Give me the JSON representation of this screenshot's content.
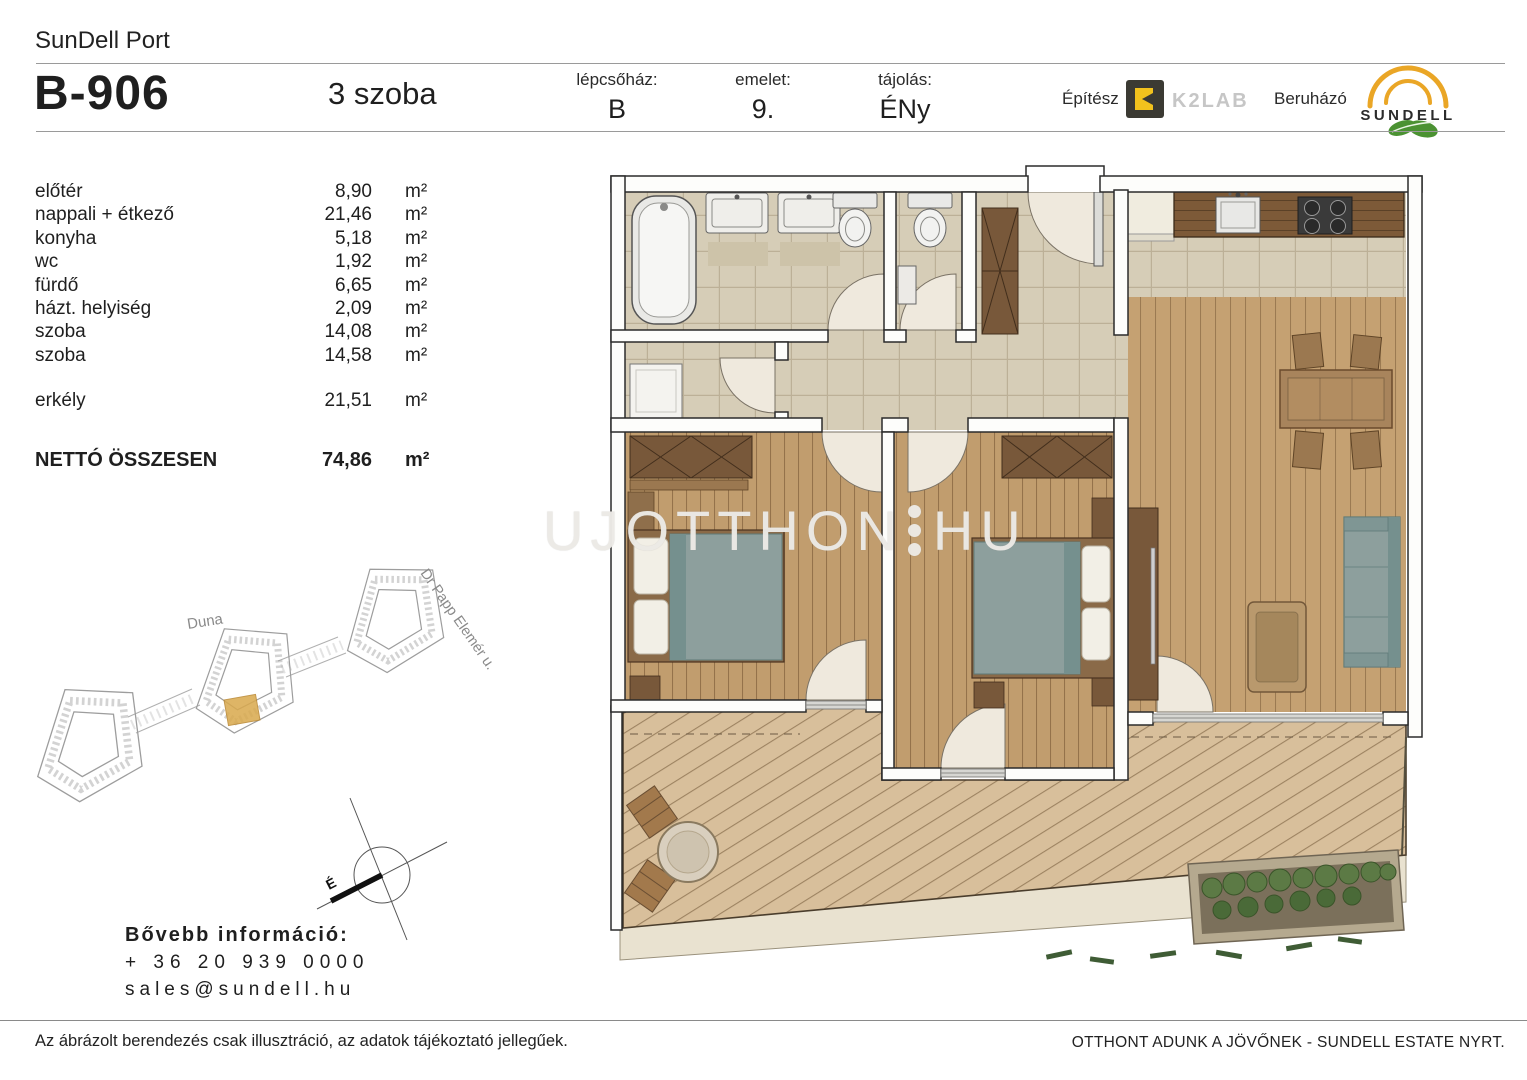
{
  "header": {
    "project": "SunDell Port",
    "unit_id": "B-906",
    "unit_type": "3 szoba",
    "fields": [
      {
        "label": "lépcsőház:",
        "value": "B"
      },
      {
        "label": "emelet:",
        "value": "9."
      },
      {
        "label": "tájolás:",
        "value": "ÉNy"
      }
    ],
    "architect_label": "Építész",
    "architect_name": "K2LAB",
    "developer_label": "Beruházó",
    "developer_name": "SUNDELL"
  },
  "rooms": {
    "items": [
      {
        "name": "előtér",
        "area": "8,90",
        "unit": "m²"
      },
      {
        "name": "nappali + étkező",
        "area": "21,46",
        "unit": "m²"
      },
      {
        "name": "konyha",
        "area": "5,18",
        "unit": "m²"
      },
      {
        "name": "wc",
        "area": "1,92",
        "unit": "m²"
      },
      {
        "name": "fürdő",
        "area": "6,65",
        "unit": "m²"
      },
      {
        "name": "házt. helyiség",
        "area": "2,09",
        "unit": "m²"
      },
      {
        "name": "szoba",
        "area": "14,08",
        "unit": "m²"
      },
      {
        "name": "szoba",
        "area": "14,58",
        "unit": "m²"
      }
    ],
    "balcony": {
      "name": "erkély",
      "area": "21,51",
      "unit": "m²"
    },
    "total": {
      "name": "NETTÓ ÖSSZESEN",
      "area": "74,86",
      "unit": "m²"
    }
  },
  "site_map": {
    "street1": "Duna",
    "street2": "Dr Papp Elemér u."
  },
  "compass": {
    "north": "É"
  },
  "watermark": {
    "left": "UJOTTHON",
    "right": "HU"
  },
  "contact": {
    "title": "Bővebb információ:",
    "phone": "+ 36 20 939 0000",
    "email": "sales@sundell.hu"
  },
  "footer": {
    "left": "Az ábrázolt berendezés csak illusztráció, az adatok tájékoztató jellegűek.",
    "right": "OTTHONT ADUNK A JÖVŐNEK - SUNDELL ESTATE NYRT."
  },
  "colors": {
    "brand_yellow": "#eaa626",
    "k2lab_yellow": "#f2c21d",
    "leaf_green": "#4b9232",
    "highlight_orange": "#d9a94c",
    "upholstery_teal": "#8d9f9d"
  }
}
